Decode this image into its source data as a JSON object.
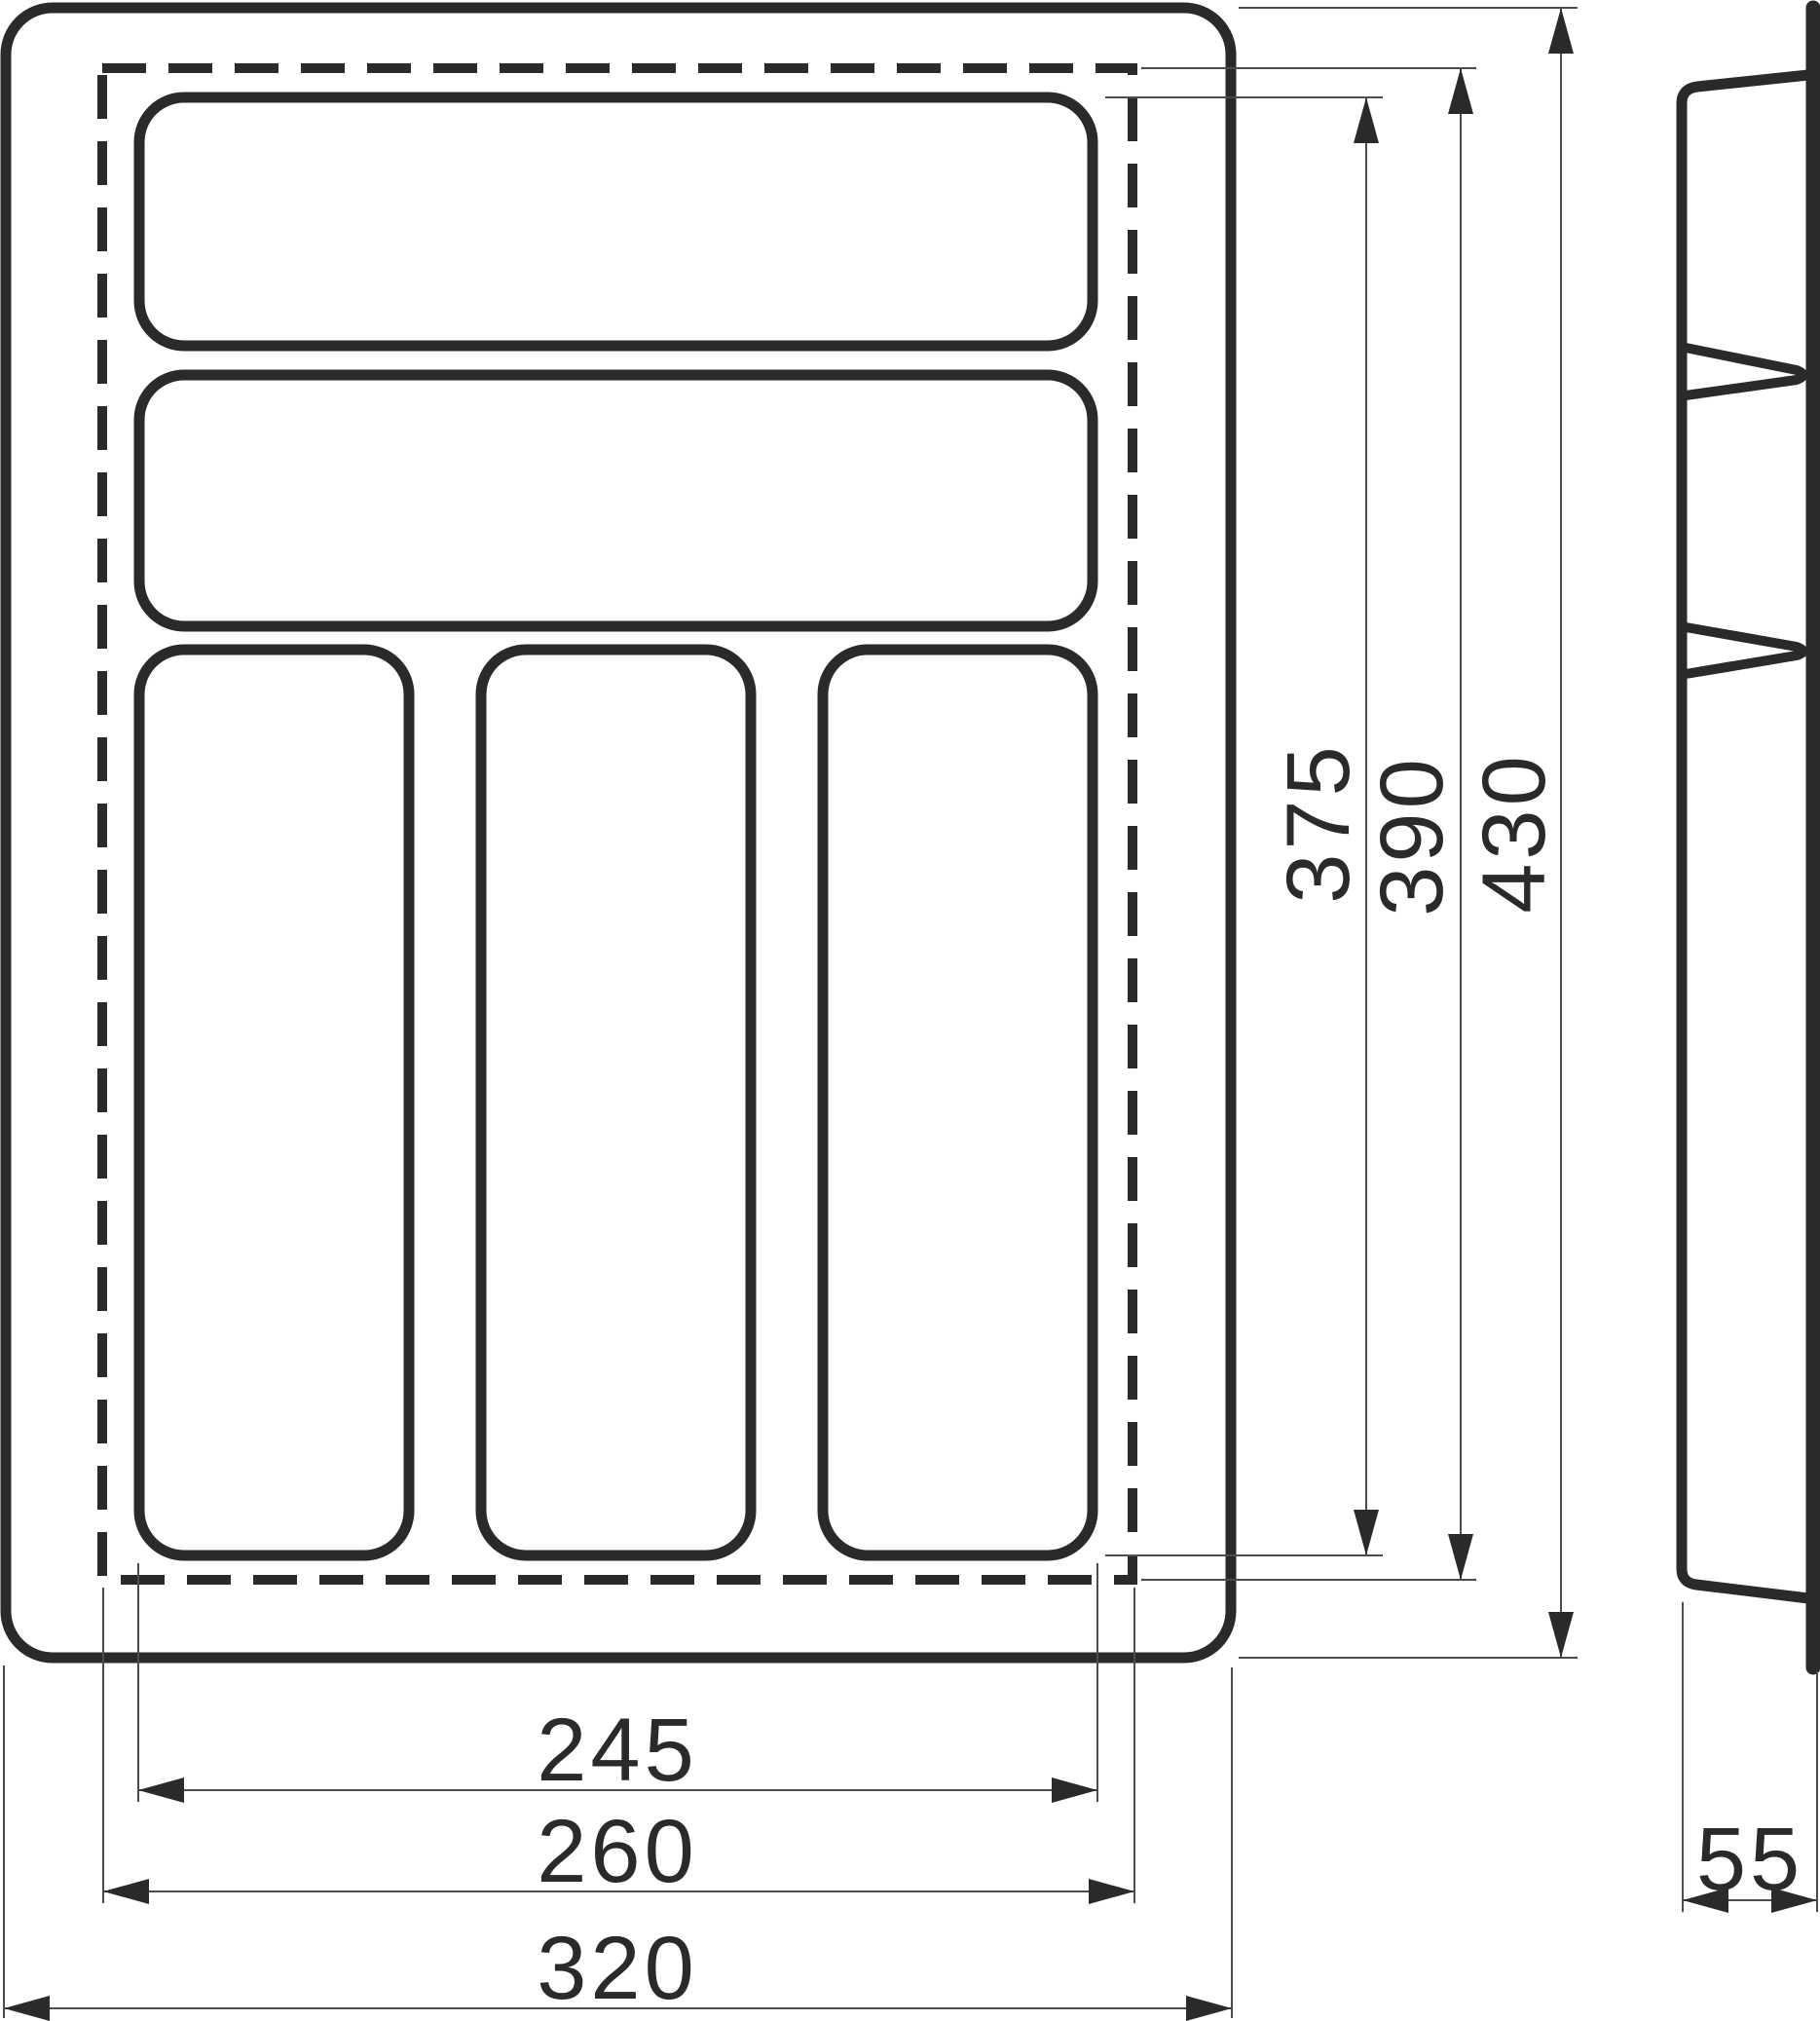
{
  "dimensions": {
    "compartment_width": "245",
    "inner_width": "260",
    "overall_width": "320",
    "compartment_height": "375",
    "inner_height": "390",
    "overall_height": "430",
    "side_depth": "55"
  },
  "colors": {
    "line": "#2b2a29",
    "thin_line": "#4d4d4d",
    "background": "#ffffff"
  }
}
